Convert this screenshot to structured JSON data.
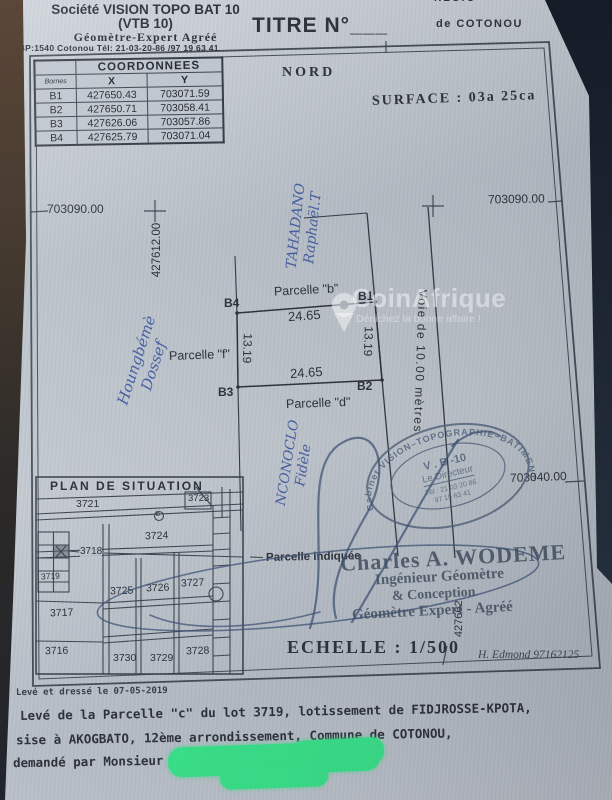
{
  "watermark": {
    "brand": "CoinAfrique",
    "tagline": "Dénichez la bonne affaire !"
  },
  "header": {
    "region_partial": "RÉGIO",
    "company": "Société VISION TOPO BAT 10",
    "company_acronym": "(VTB 10)",
    "company_role": "Géomètre-Expert Agréé",
    "company_address": "02 BP:1540 Cotonou Tél: 21-03-20-86 /97 19 63 41",
    "doc_title": "TITRE N°",
    "doc_title_blank": "___",
    "city": "de COTONOU"
  },
  "coordinates_table": {
    "title": "COORDONNEES",
    "col_bornes": "Bornes",
    "col_x": "X",
    "col_y": "Y",
    "rows": [
      {
        "borne": "B1",
        "x": "427650.43",
        "y": "703071.59"
      },
      {
        "borne": "B2",
        "x": "427650.71",
        "y": "703058.41"
      },
      {
        "borne": "B3",
        "x": "427626.06",
        "y": "703057.86"
      },
      {
        "borne": "B4",
        "x": "427625.79",
        "y": "703071.04"
      }
    ]
  },
  "compass_label": "NORD",
  "surface_label": "SURFACE : 03a 25ca",
  "plan": {
    "grid_y_top_left": "703090.00",
    "grid_y_top_right": "703090.00",
    "grid_y_mid_right": "703040.00",
    "grid_x_left": "427612.00",
    "grid_x_right": "427662",
    "road_label": "Voie  de  10.00  mètres",
    "parcel_b_label": "Parcelle \"b\"",
    "parcel_d_label": "Parcelle \"d\"",
    "parcel_f_label": "Parcelle \"f\"",
    "len_top": "24.65",
    "len_bottom": "24.65",
    "len_left": "13.19",
    "len_right": "13.19",
    "corner_b1": "B1",
    "corner_b2": "B2",
    "corner_b3": "B3",
    "corner_b4": "B4",
    "handwriting_top_line1": "TAHADANO",
    "handwriting_top_line2": "Raphaël.T",
    "handwriting_left_line1": "Houngbémè",
    "handwriting_left_line2": "Dossef",
    "handwriting_bottom_line1": "NCONOCLO",
    "handwriting_bottom_line2": "Fidèle"
  },
  "situation": {
    "title": "PLAN  DE  SITUATION",
    "lot_3721": "3721",
    "lot_3723": "3723",
    "lot_3724": "3724",
    "lot_3718": "3718",
    "lot_3719": "3719",
    "lot_3725": "3725",
    "lot_3726": "3726",
    "lot_3727": "3727",
    "lot_3717": "3717",
    "lot_3716": "3716",
    "lot_3730": "3730",
    "lot_3729": "3729",
    "lot_3728": "3728",
    "road_marker": "b"
  },
  "stamp": {
    "ring": "Cabinet  VISION–TOPOGRAPHIE–BATIMENT-10",
    "line1": "V . B -10",
    "line2": "Le  Directeur",
    "line3": "Tél : 21 03 20 86",
    "line4": "97 19 63 41"
  },
  "attribution": {
    "pointer_label": "Parcelle indiquée",
    "surveyor_name": "Charles A. WODEME",
    "surveyor_role1": "Ingénieur Géomètre",
    "surveyor_role2": "& Conception",
    "surveyor_role3": "Géomètre Expert - Agréé",
    "scale_label": "ECHELLE : 1/500",
    "agent_note": "H. Edmond 97162125"
  },
  "footer": {
    "drawn_date": "Levé et dressé le  07-05-2019",
    "line1": "Levé de la Parcelle \"c\" du lot 3719, lotissement de FIDJROSSE-KPOTA,",
    "line2": "sise à AKOGBATO, 12ème arrondissement, Commune de COTONOU,",
    "line3": "demandé par Monsieur"
  },
  "colors": {
    "paper": "#c1c7cf",
    "ink": "#2f343c",
    "handwriting_blue": "#3e58a0",
    "stamp_gray": "#53637b",
    "redaction_green": "#3ae28a",
    "photo_edge_brown": "#4a3a2e",
    "photo_edge_navy": "#1c2532"
  }
}
